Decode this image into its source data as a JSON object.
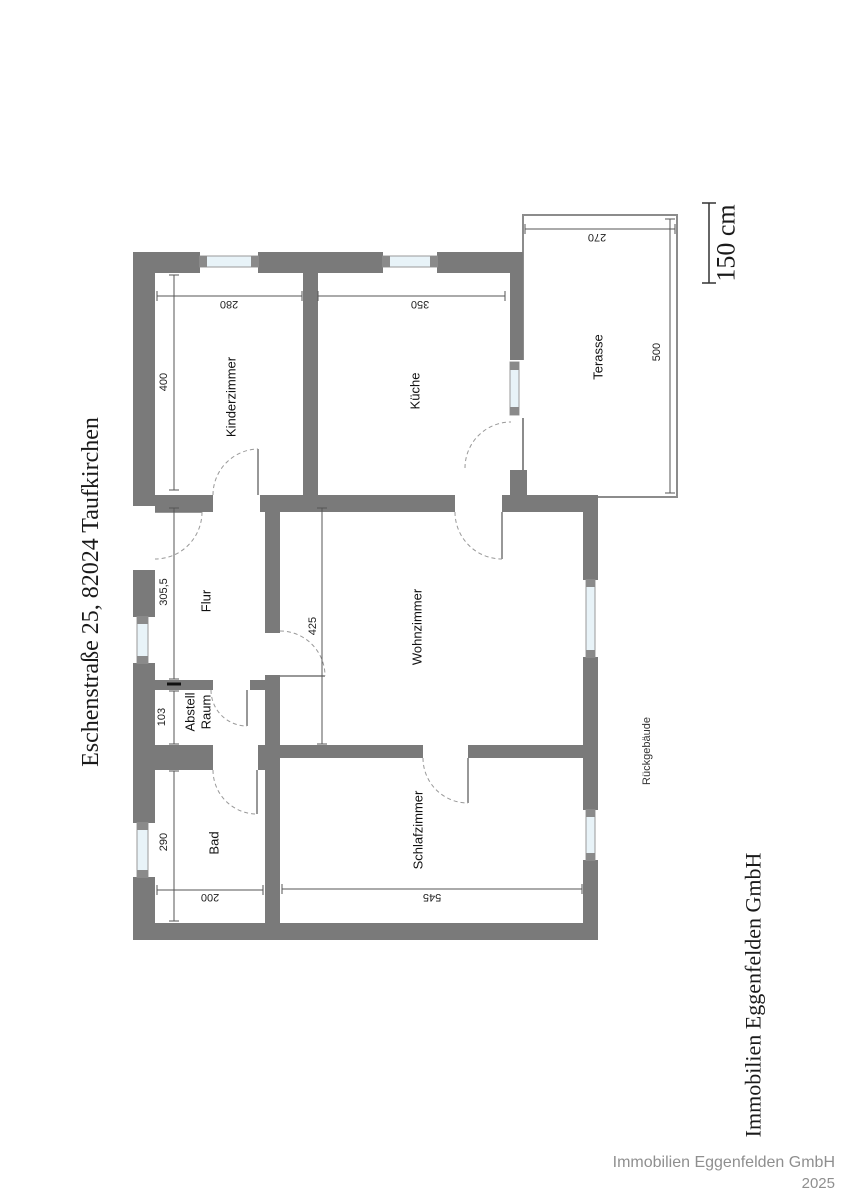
{
  "page": {
    "address": "Eschenstraße 25, 82024 Taufkirchen",
    "side_company": "Immobilien Eggenfelden GmbH",
    "rear_building_label": "Rückgebäude",
    "footer": {
      "company": "Immobilien Eggenfelden GmbH",
      "year": "2025"
    }
  },
  "scale_bar": {
    "label": "150 cm"
  },
  "colors": {
    "wall": "#7a7a7a",
    "window_glass": "#e8f3f8",
    "dimension_line": "#555555",
    "footer_text": "#8f8f8f"
  },
  "rooms": {
    "kinderzimmer": {
      "label": "Kinderzimmer",
      "width": "280",
      "depth": "400"
    },
    "kueche": {
      "label": "Küche",
      "width": "350"
    },
    "terrasse": {
      "label": "Terasse",
      "width": "270",
      "depth": "500"
    },
    "flur": {
      "label": "Flur",
      "depth": "305,5"
    },
    "abstellraum": {
      "label_line1": "Abstell",
      "label_line2": "Raum",
      "depth": "103"
    },
    "wohnzimmer": {
      "label": "Wohnzimmer",
      "depth": "425"
    },
    "bad": {
      "label": "Bad",
      "width": "200",
      "depth": "290"
    },
    "schlafzimmer": {
      "label": "Schlafzimmer",
      "width": "545"
    }
  }
}
